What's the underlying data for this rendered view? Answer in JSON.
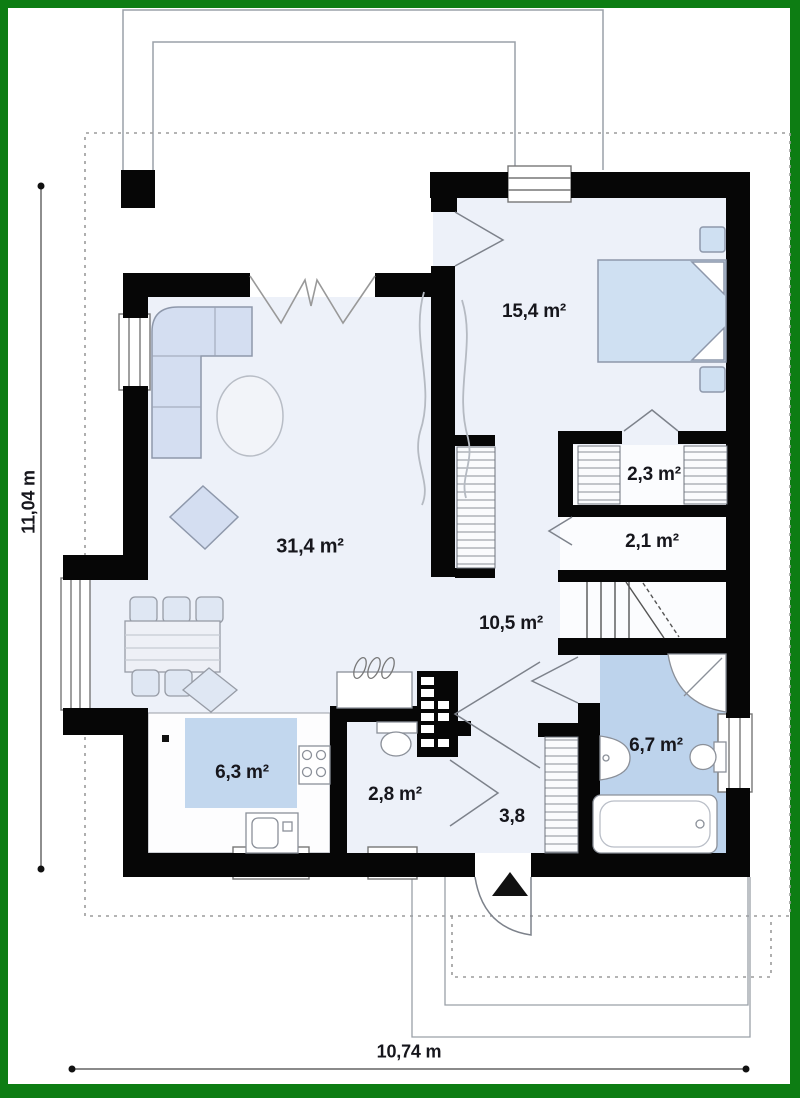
{
  "title": "single-storey house floor plan",
  "rooms": [
    {
      "id": "living-room",
      "label": "31,4 m²"
    },
    {
      "id": "bedroom",
      "label": "15,4 m²"
    },
    {
      "id": "closet",
      "label": "2,3 m²"
    },
    {
      "id": "corridor",
      "label": "2,1 m²"
    },
    {
      "id": "hall",
      "label": "10,5 m²"
    },
    {
      "id": "bathroom",
      "label": "6,7 m²"
    },
    {
      "id": "kitchen",
      "label": "6,3 m²"
    },
    {
      "id": "wc",
      "label": "2,8 m²"
    },
    {
      "id": "entry",
      "label": "3,8"
    }
  ],
  "dimensions": {
    "overall_width": "10,74 m",
    "overall_height": "11,04 m"
  },
  "colors": {
    "frame_green": "#0d7d13",
    "wall_black": "#060606",
    "floor_light": "#edf1f9",
    "floor_accent": "#c2d7ee",
    "furniture_fill": "#d4def1",
    "outline_gray": "#9aa0a8"
  }
}
